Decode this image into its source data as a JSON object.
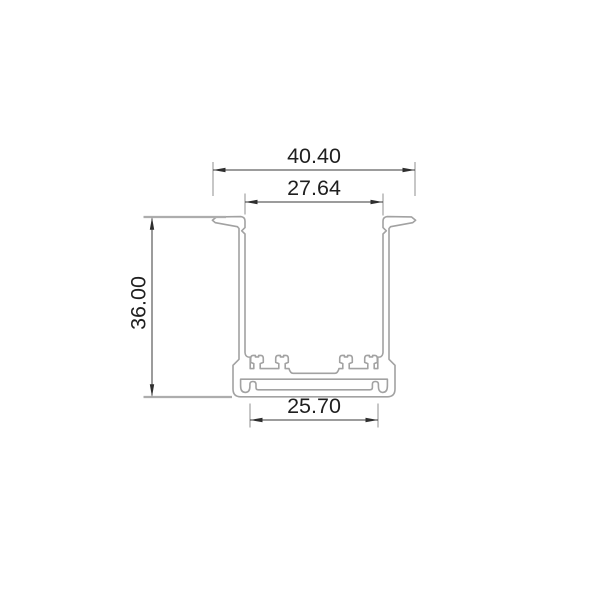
{
  "drawing": {
    "title": "aluminium-profile-cross-section",
    "dimensions": {
      "outer_width": {
        "label": "40.40"
      },
      "inner_width": {
        "label": "27.64"
      },
      "height": {
        "label": "36.00"
      },
      "base_width": {
        "label": "25.70"
      }
    },
    "colors": {
      "profile_stroke": "#a2a2a2",
      "dimension_stroke": "#3a3a3a",
      "extension_stroke": "#8f8f8f",
      "text_color": "#1f1f1f",
      "background": "#ffffff"
    }
  }
}
